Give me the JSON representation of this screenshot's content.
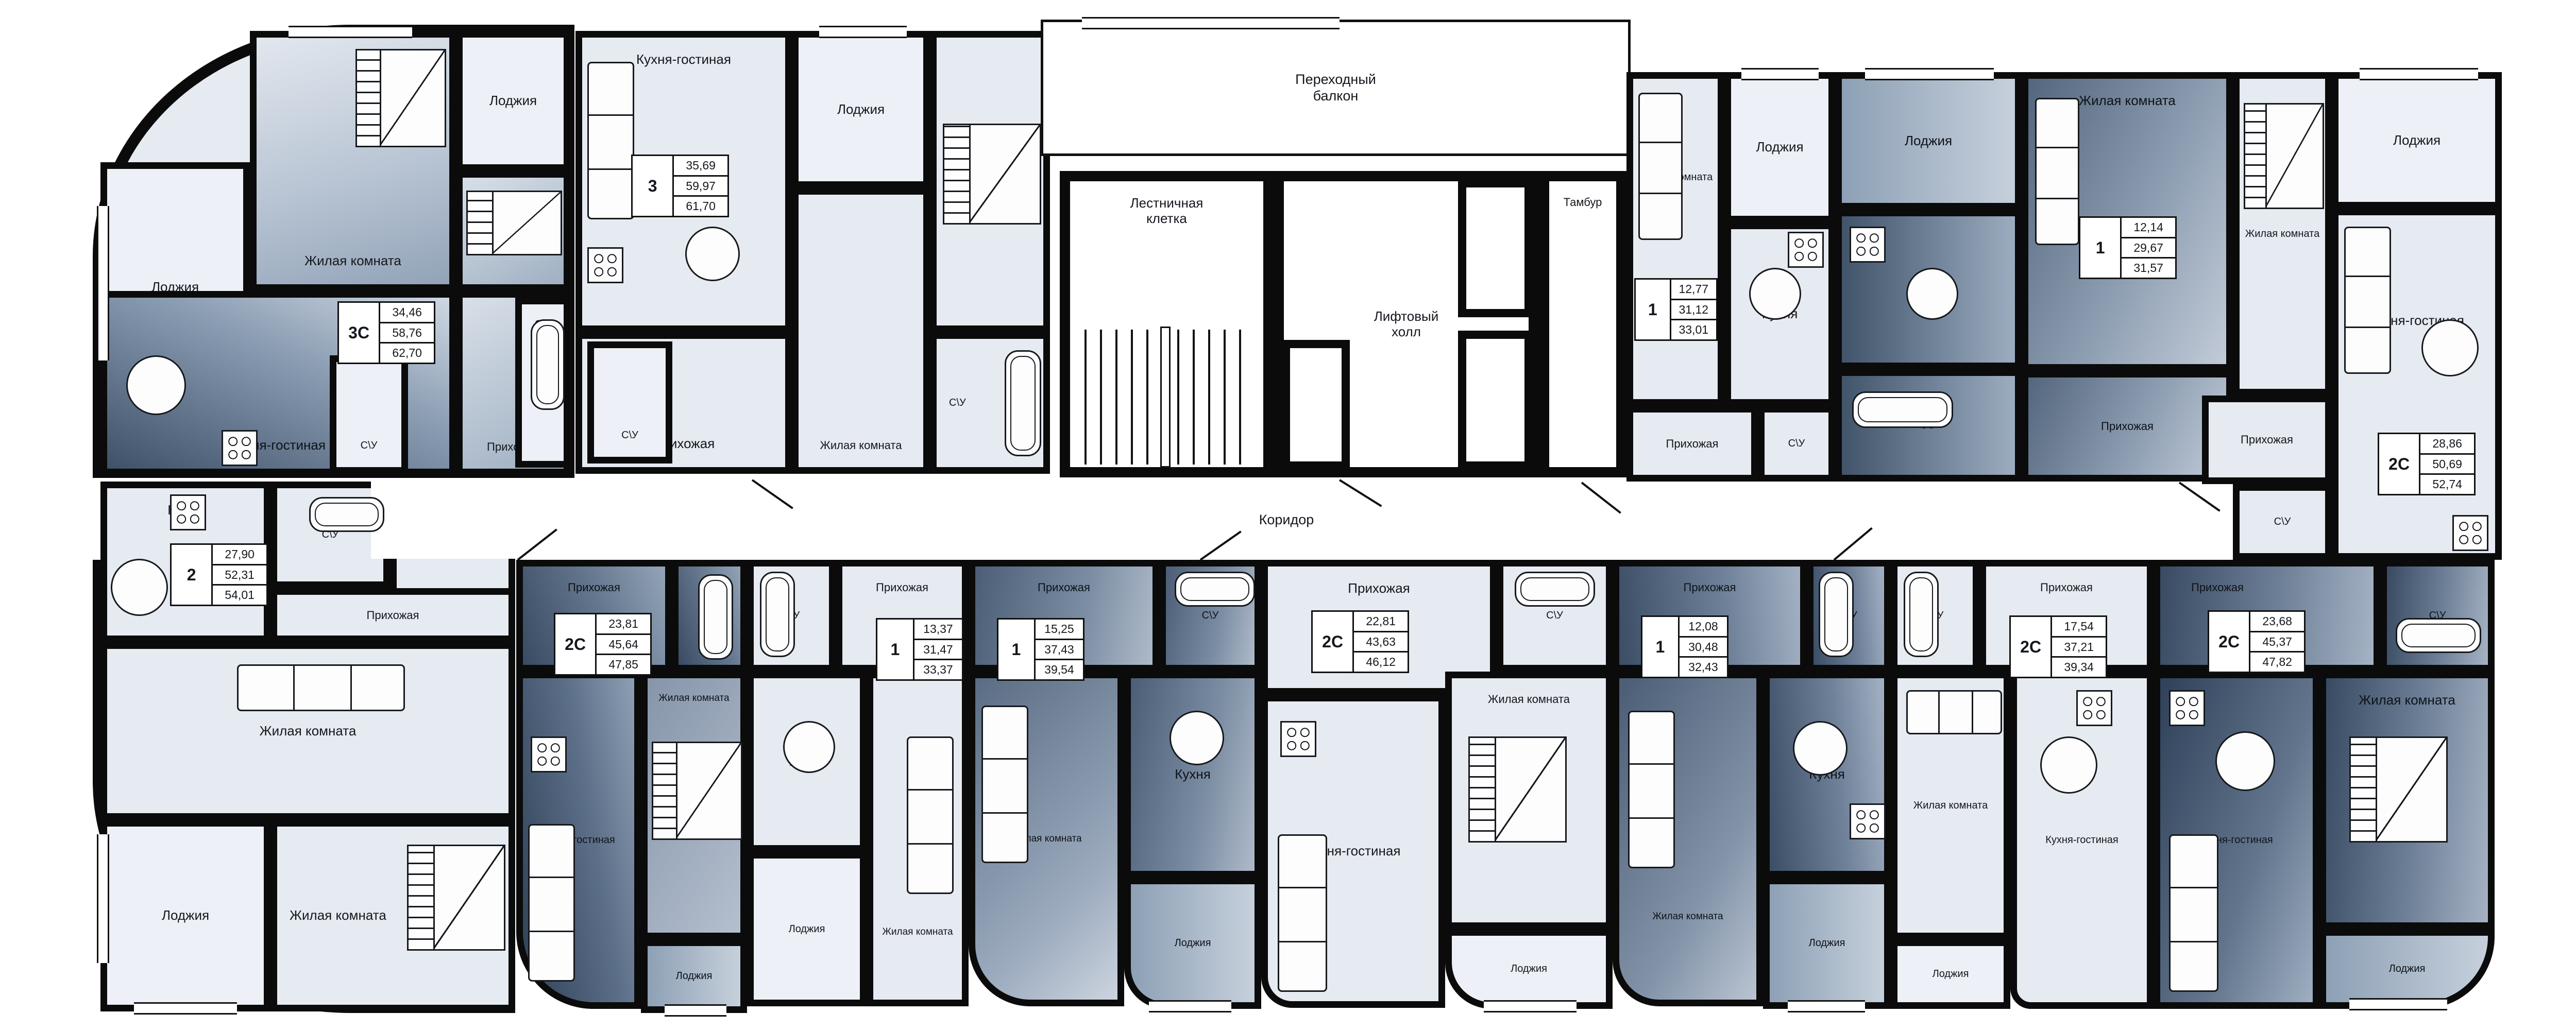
{
  "labels": {
    "loggia": "Лоджия",
    "living": "Жилая комната",
    "kitchen": "Кухня",
    "kitchen_living": "Кухня-гостиная",
    "hall": "Прихожая",
    "wc": "С\\У",
    "corridor": "Коридор",
    "stairs1": "Лестничная",
    "stairs2": "клетка",
    "elev1": "Лифтовый",
    "elev2": "холл",
    "balcony1": "Переходный",
    "balcony2": "балкон",
    "tambour": "Тамбур"
  },
  "apartments": [
    {
      "type": "3С",
      "areas": [
        "34,46",
        "58,76",
        "62,70"
      ]
    },
    {
      "type": "3",
      "areas": [
        "35,69",
        "59,97",
        "61,70"
      ]
    },
    {
      "type": "1",
      "areas": [
        "12,77",
        "31,12",
        "33,01"
      ]
    },
    {
      "type": "1",
      "areas": [
        "12,14",
        "29,67",
        "31,57"
      ]
    },
    {
      "type": "2С",
      "areas": [
        "28,86",
        "50,69",
        "52,74"
      ]
    },
    {
      "type": "2",
      "areas": [
        "27,90",
        "52,31",
        "54,01"
      ]
    },
    {
      "type": "2С",
      "areas": [
        "23,81",
        "45,64",
        "47,85"
      ]
    },
    {
      "type": "1",
      "areas": [
        "13,37",
        "31,47",
        "33,37"
      ]
    },
    {
      "type": "1",
      "areas": [
        "15,25",
        "37,43",
        "39,54"
      ]
    },
    {
      "type": "2С",
      "areas": [
        "22,81",
        "43,63",
        "46,12"
      ]
    },
    {
      "type": "1",
      "areas": [
        "12,08",
        "30,48",
        "32,43"
      ]
    },
    {
      "type": "2С",
      "areas": [
        "17,54",
        "37,21",
        "39,34"
      ]
    },
    {
      "type": "2С",
      "areas": [
        "23,68",
        "45,37",
        "47,82"
      ]
    }
  ],
  "colors": {
    "wall": "#0b0b0b",
    "room_light": "#e6eaf1",
    "room_dark": "#3f5168",
    "paper": "#ffffff"
  }
}
